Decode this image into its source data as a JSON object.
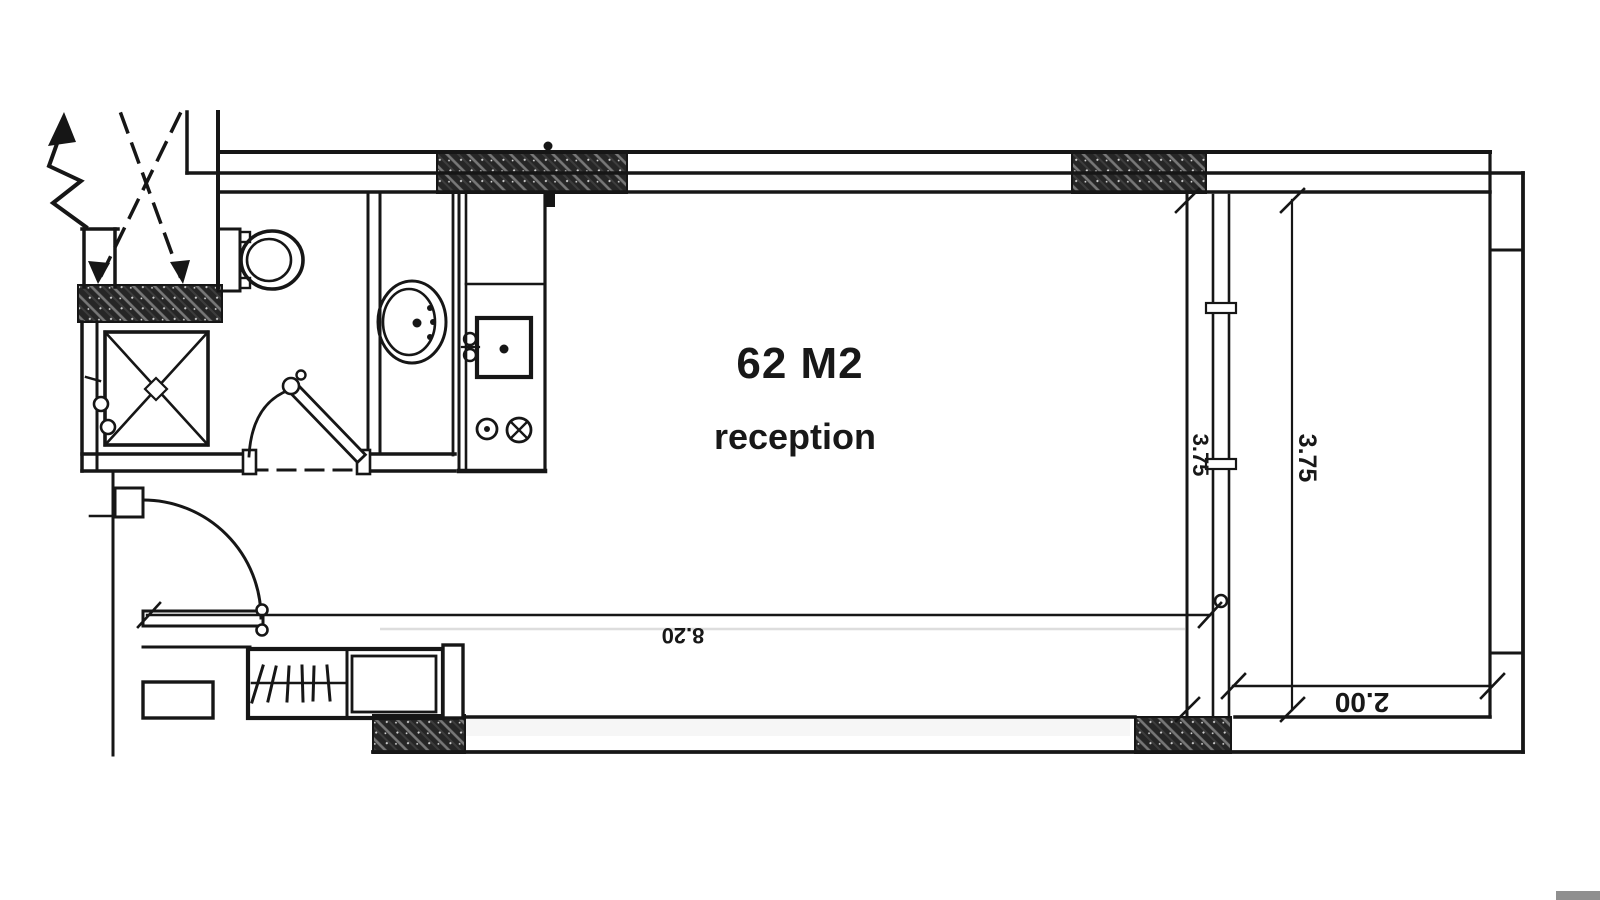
{
  "drawing": {
    "room": {
      "area_label": "62 M2",
      "name_label": "reception"
    },
    "dimensions": {
      "bottom_width": "8.20",
      "room_depth": "3.75",
      "terrace_depth": "3.75",
      "terrace_width": "2.00"
    },
    "fixtures": [
      "toilet",
      "washbasin-oval",
      "shower-tray",
      "shower-valve",
      "kitchen-sink-square",
      "cooktop-burners",
      "wardrobe-hangers",
      "shoe-cabinet",
      "entry-door-swing",
      "bathroom-door-swing",
      "glazed-partition",
      "shaft-cross-arrows",
      "break-line-arrow"
    ],
    "colors": {
      "ink": "#161616",
      "paper": "#ffffff",
      "hatch_bg": "#262626",
      "hatch_line": "#787878",
      "scrollbar_corner": "#8f8f8f"
    }
  }
}
